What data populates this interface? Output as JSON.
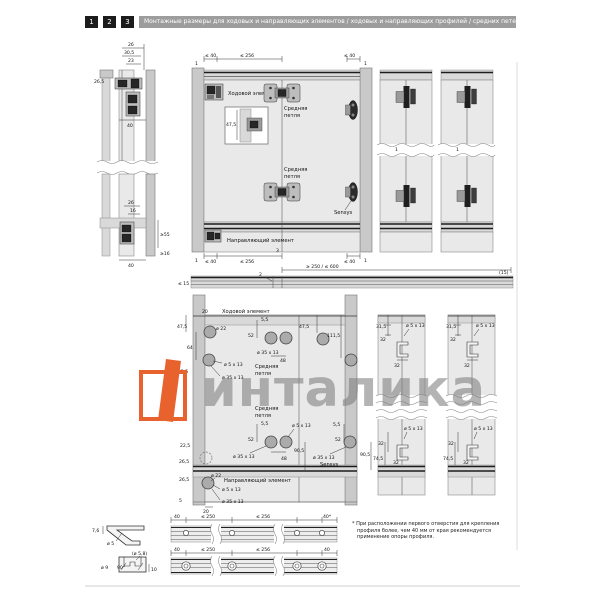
{
  "header": {
    "steps": [
      "1",
      "2",
      "3"
    ],
    "title": "Монтажные размеры для ходовых и направляющих элементов / ходовых и направляющих профилей / средних петель"
  },
  "watermark": {
    "text": "инталика",
    "logo_color": "#e8622d"
  },
  "labels": {
    "running": "Ходовой элемент",
    "hinge_line1": "Средняя",
    "hinge_line2": "петля",
    "sensys": "Sensys",
    "guide": "Направляющий элемент"
  },
  "note": {
    "line1": "* При расположении первого отверстия для крепления",
    "line2": "профиля более, чем 40 мм от края рекомендуется",
    "line3": "применение опоры профиля."
  },
  "dims": {
    "tl_26": "26",
    "tl_305": "30,5",
    "tl_23": "23",
    "tl_265": "26,5",
    "tl_40": "40",
    "tl2_26": "26",
    "tl2_16": "16",
    "tl2_55": "≥55",
    "tl2_16b": "≥16",
    "tl2_40": "40",
    "le40": "≤ 40",
    "le256": "≤ 256",
    "le250": "≤ 250",
    "one": "1",
    "two": "2",
    "three": "3",
    "v475": "47,5",
    "bar_le15": "≤ 15",
    "bar_range": "≥ 250 / ≤ 600",
    "bar_15p": "(15)",
    "v315": "31,5",
    "v32": "32",
    "d5x13": "ø 5 x 13",
    "d35x13": "ø 35 x 13",
    "v745": "74,5",
    "v20": "20",
    "d22": "ø 22",
    "v64": "64",
    "v225": "22,5",
    "v55": "5,5",
    "v52": "52",
    "v48": "48",
    "v1115": "111,5",
    "v905": "90,5",
    "v265": "26,5",
    "v5": "5",
    "p76": "7,6",
    "pd5": "ø 5",
    "pd58": "(ø 5,8)",
    "pd9": "ø 9",
    "p90": "90°",
    "p10": "10",
    "p40": "40",
    "p40s": "40*"
  }
}
